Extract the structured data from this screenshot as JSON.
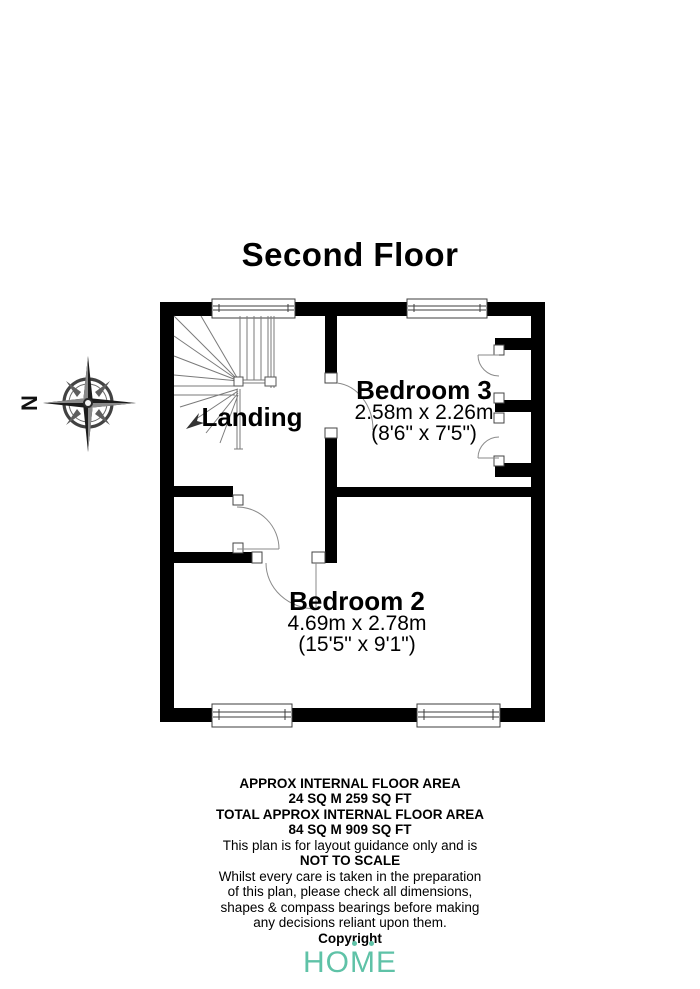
{
  "title": "Second Floor",
  "compass": {
    "north_label": "N"
  },
  "rooms": {
    "landing": {
      "name": "Landing"
    },
    "bedroom3": {
      "name": "Bedroom 3",
      "metric": "2.58m x 2.26m",
      "imperial": "(8'6\" x 7'5\")"
    },
    "bedroom2": {
      "name": "Bedroom 2",
      "metric": "4.69m x 2.78m",
      "imperial": "(15'5\" x 9'1\")"
    }
  },
  "footer": {
    "approx_area_label": "APPROX INTERNAL FLOOR AREA",
    "approx_area_value": "24 SQ M 259 SQ FT",
    "total_area_label": "TOTAL APPROX INTERNAL FLOOR AREA",
    "total_area_value": "84 SQ M 909 SQ FT",
    "guidance": "This plan is for layout guidance only and is",
    "not_to_scale": "NOT TO SCALE",
    "disclaimer": [
      "Whilst every care is taken in the preparation",
      "of this plan, please check all dimensions,",
      "shapes & compass bearings before making",
      "any decisions reliant upon them."
    ],
    "copyright": "Copyright"
  },
  "logo": {
    "letters": [
      "H",
      "O",
      "M",
      "E"
    ],
    "color": "#5fc2a7"
  }
}
